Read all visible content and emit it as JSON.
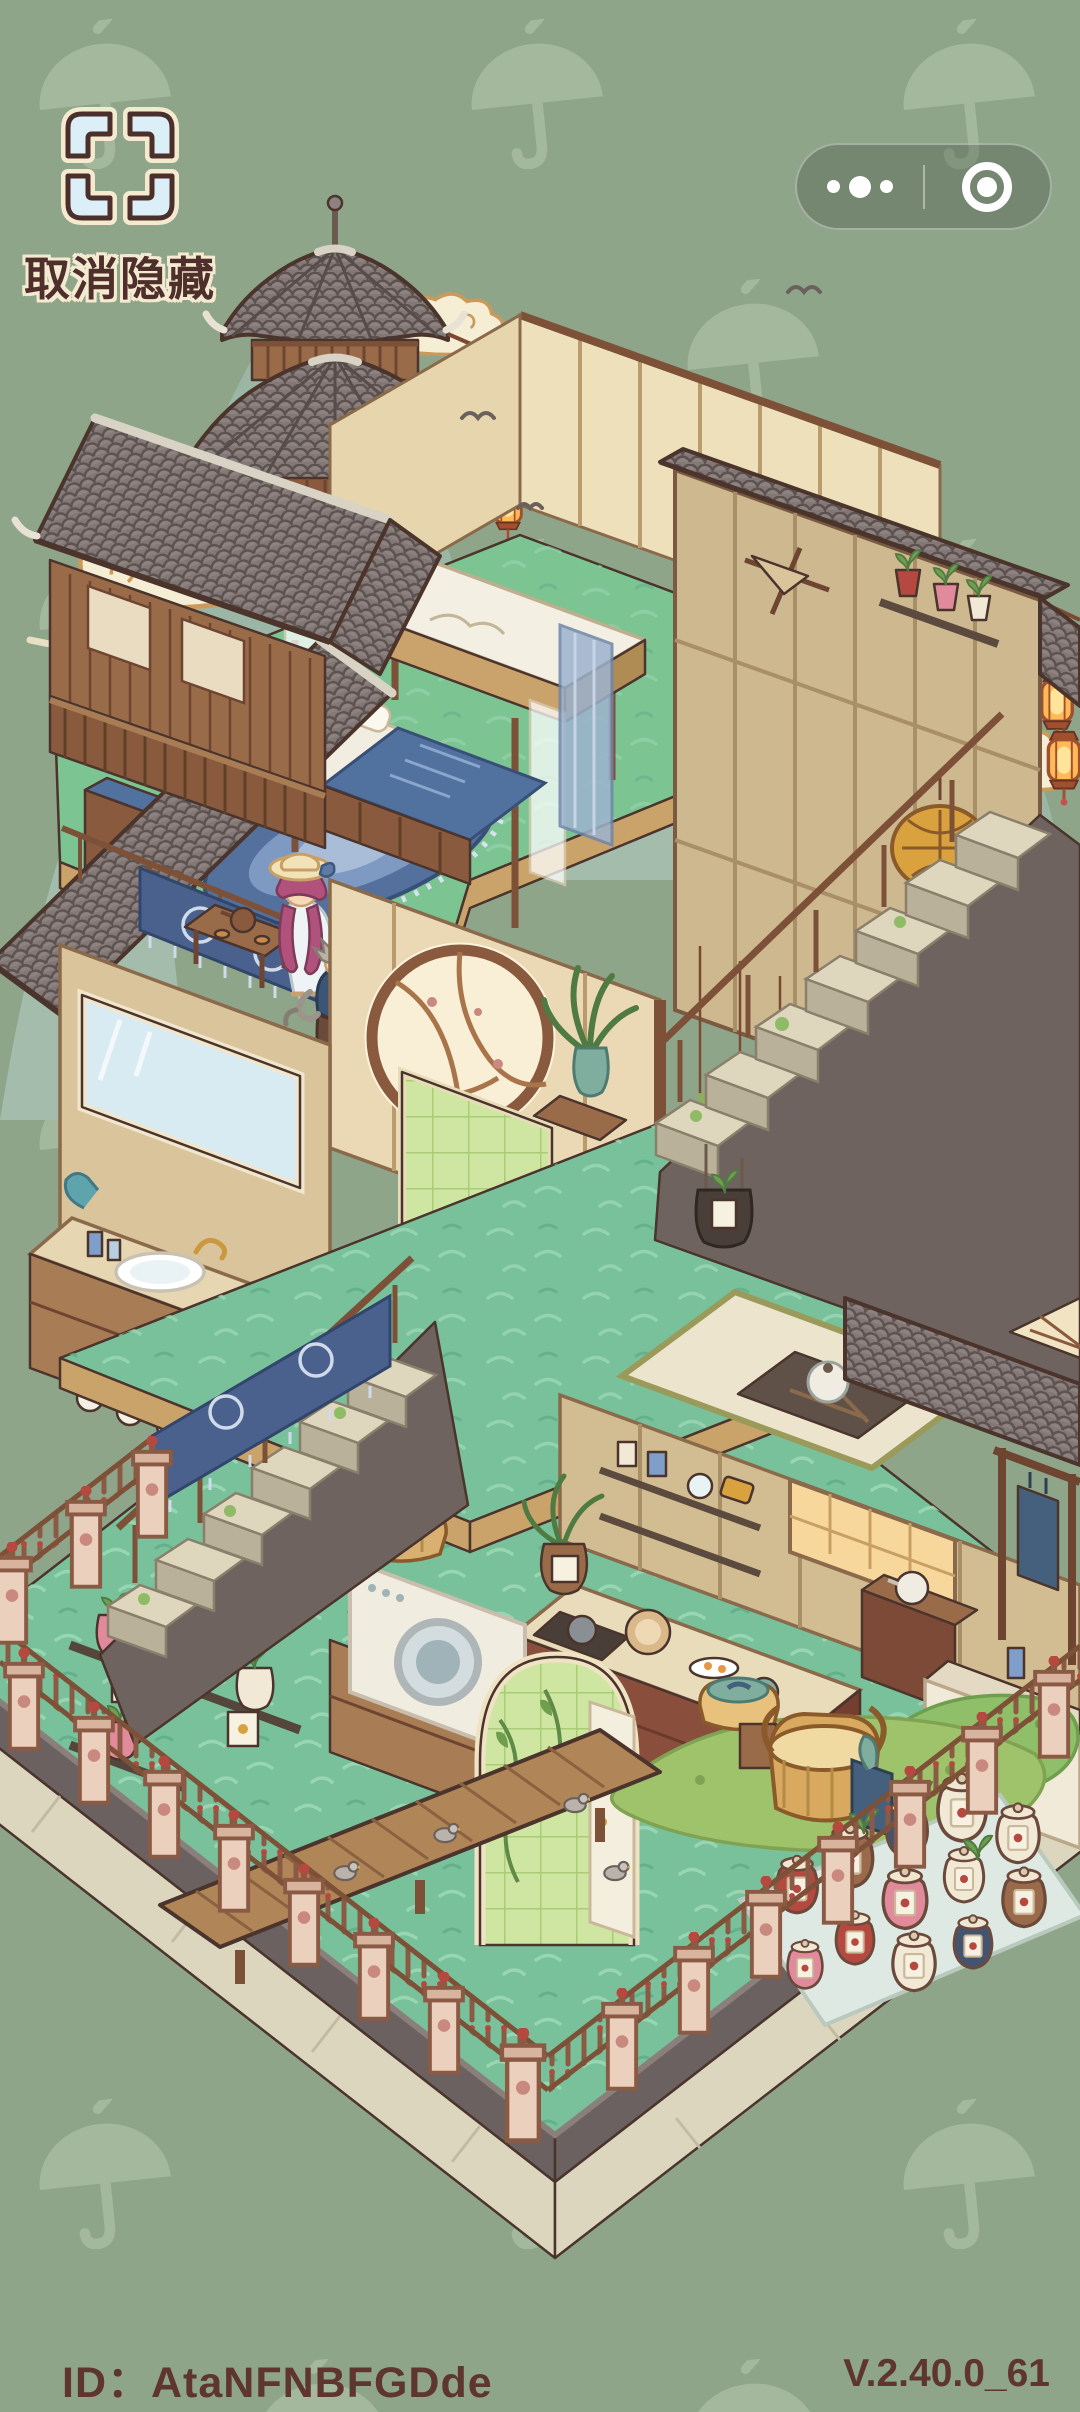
{
  "top_bar": {
    "hide_button": {
      "label": "取消隐藏",
      "icon": "corner-brackets-icon"
    },
    "capsule": {
      "more_icon": "more-dots-icon",
      "exit_icon": "target-circle-icon"
    }
  },
  "footer": {
    "player_id": "ID：AtaNFNBFGDde",
    "version": "V.2.40.0_61"
  },
  "palette": {
    "background": "#8fa58a",
    "watermark": "#b9cbb1",
    "text_brown": "#5e352f",
    "cream": "#f1e4c2",
    "wood": "#a87c54",
    "wood_dark": "#7d5137",
    "roof_gray": "#837876",
    "wall_taupe": "#6f6360",
    "floor_green": "#7cc492",
    "ground_teal": "#79c19b",
    "textile_blue": "#51719f",
    "lantern_orange": "#f2a64e",
    "fence_pink": "#ead0bd",
    "glass_green": "#cfe6a2"
  },
  "scene": {
    "watermark_icon": "umbrella-icon",
    "landmarks": [
      "pagoda-tower",
      "bedroom",
      "balcony-walkway",
      "moon-window",
      "bathroom",
      "staircase-upper",
      "staircase-lower",
      "kitchen",
      "laundry-corner",
      "wooden-deck",
      "herb-jar-garden",
      "garden-fence"
    ],
    "characters": [
      {
        "name": "girl-in-sun-hat",
        "features": "straw hat, purple hair, white dress"
      },
      {
        "name": "gray-haired-elder",
        "features": "silver hair, blue robe, brown skirt, feather fan"
      }
    ]
  }
}
